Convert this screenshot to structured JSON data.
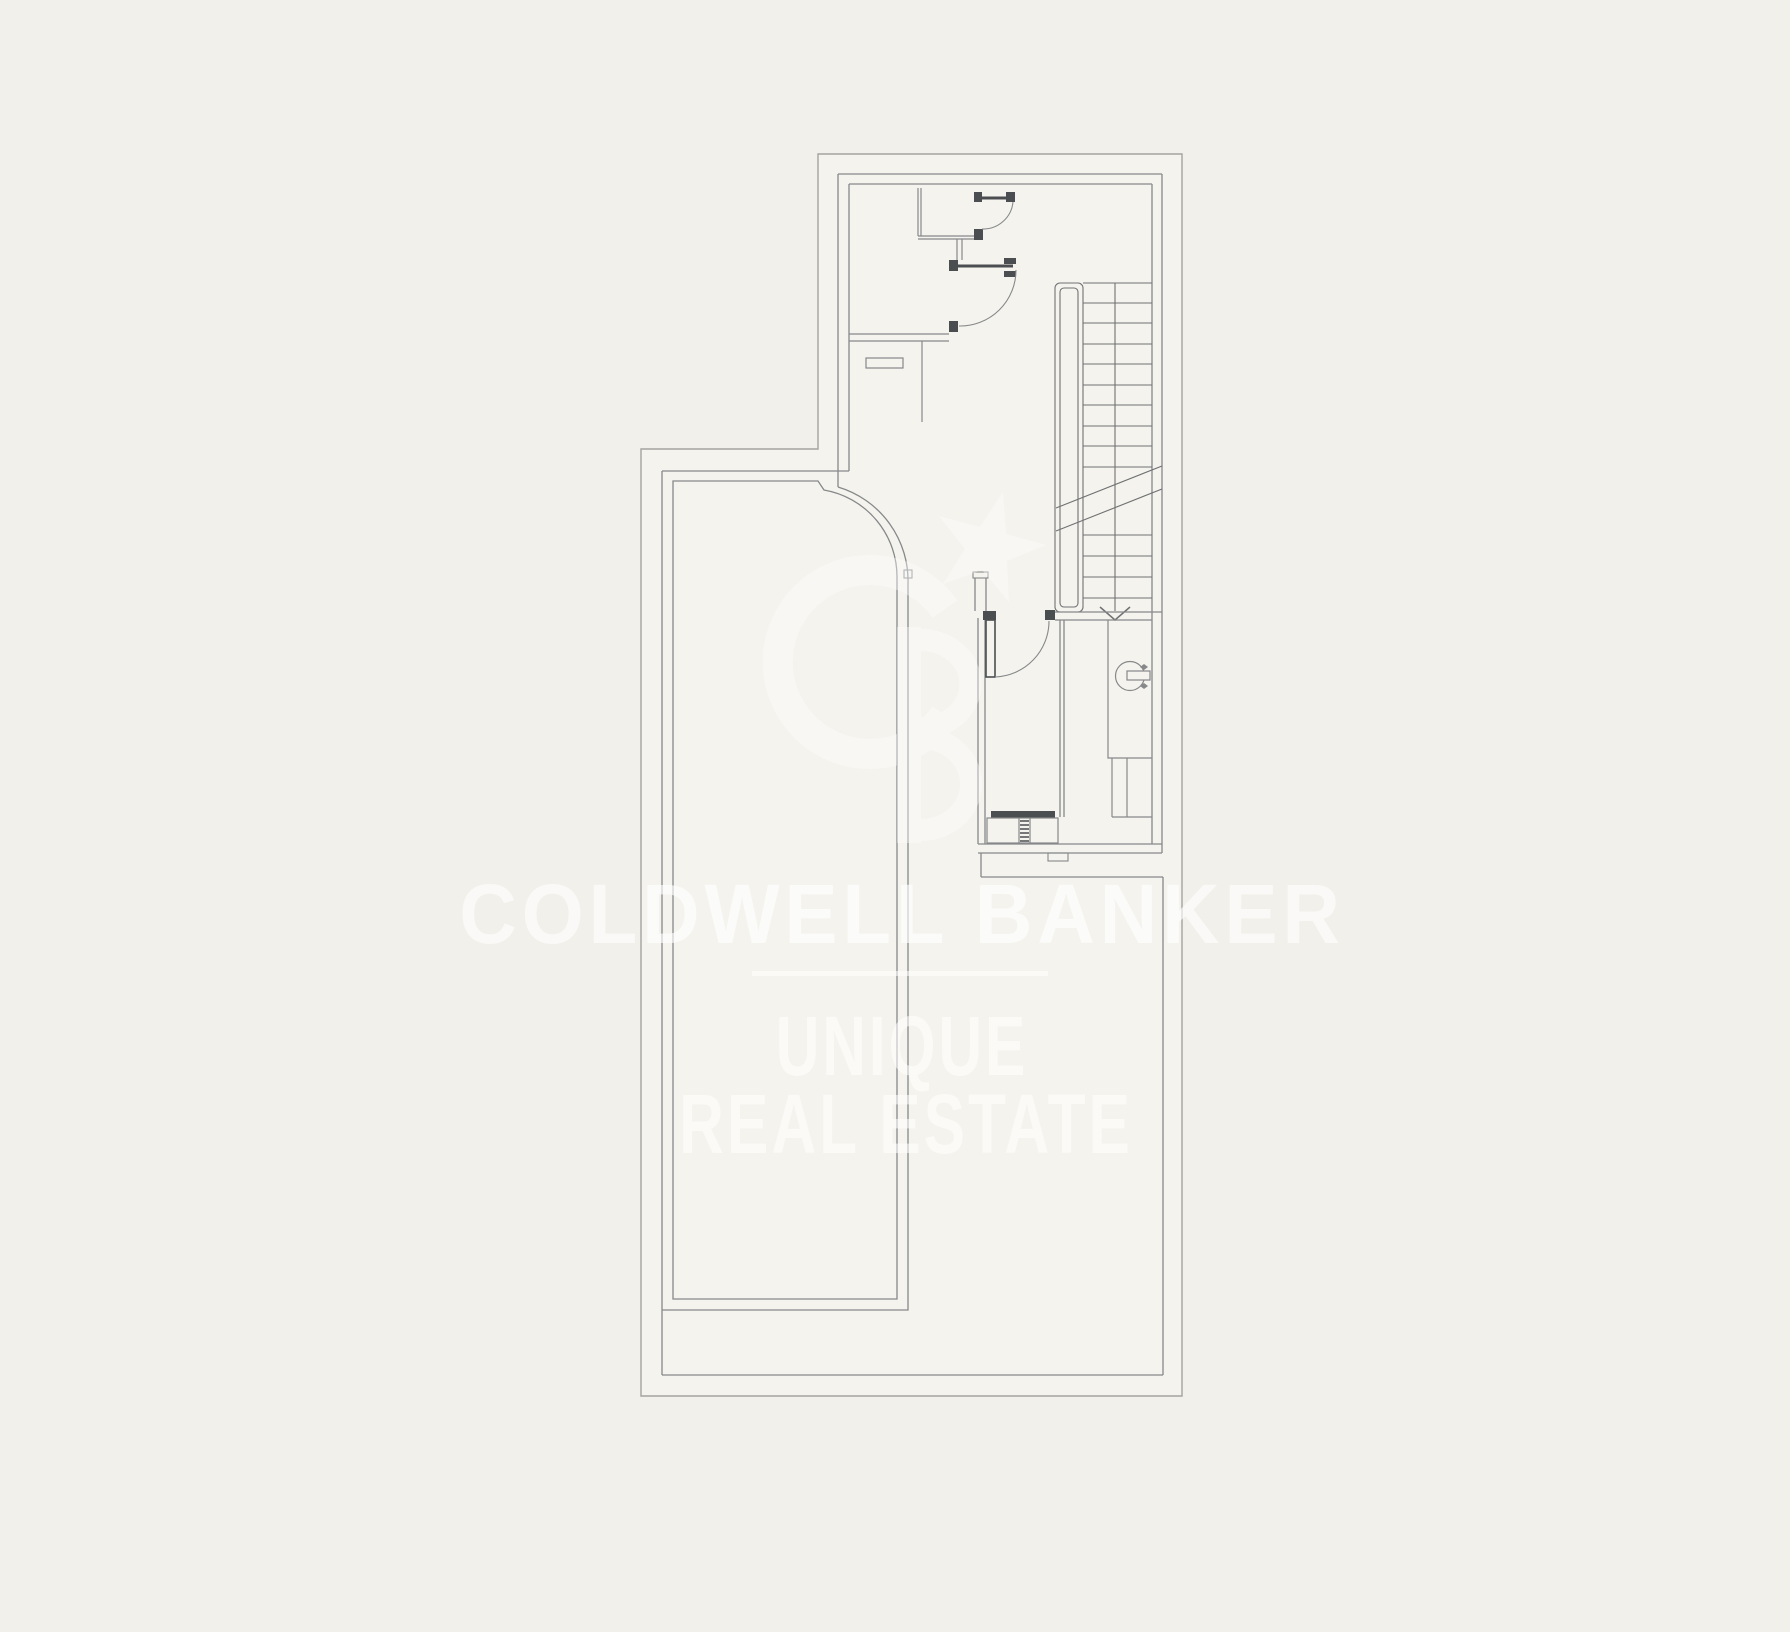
{
  "canvas": {
    "width": 1790,
    "height": 1632,
    "background_color": "#f2f0ea",
    "plan_interior_color": "#f5f3ee",
    "wall_line_color": "#86888a",
    "boundary_line_color": "#a3a3a0",
    "dark_fixture_color": "#4b4e50",
    "watermark_color": "#ffffff"
  },
  "watermark": {
    "brand_text": "COLDWELL BANKER",
    "tagline_line_1": "UNIQUE",
    "tagline_line_2": "REAL ESTATE",
    "divider": "horizontal-rule",
    "logo_icon": "coldwell-banker-cb-star-monogram"
  },
  "floor_plan": {
    "type": "architectural-floor-plan",
    "labels": [],
    "elements": [
      "exterior-boundary-wall",
      "entry-hall",
      "closet-partition-with-door",
      "swing-door-upper",
      "swing-door-middle",
      "swing-door-utility-room",
      "staircase-with-railing",
      "stair-break-line",
      "stair-direction-arrow",
      "utility-room",
      "boiler-unit-circle-symbol",
      "hatched-appliance",
      "wall-shelf-marker",
      "pool-with-rounded-corner",
      "terrace-area"
    ]
  }
}
